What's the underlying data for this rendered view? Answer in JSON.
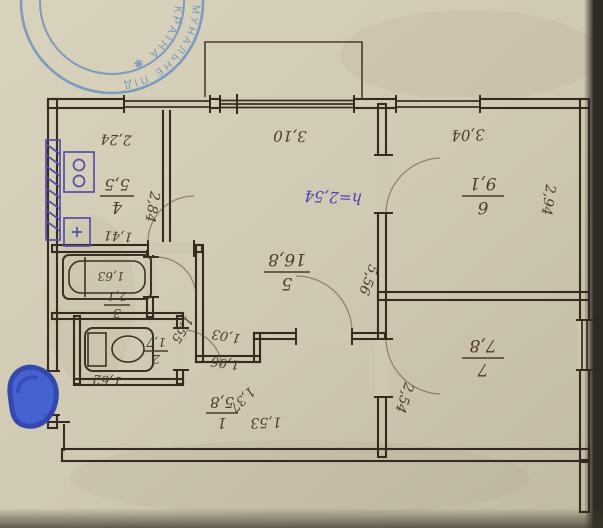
{
  "stamp": {
    "ring_outer": "ЖИТЛОВО КОМУНАЛЬНЕ ПІД",
    "ring_inner": "✱ УКРАЇНА ✱"
  },
  "note": {
    "ceiling_height": "h=2,54"
  },
  "rooms": {
    "kitchen": {
      "number": "4",
      "area": "5,5"
    },
    "living": {
      "number": "5",
      "area": "16,8"
    },
    "bedroom6": {
      "number": "6",
      "area": "9,1"
    },
    "bedroom7": {
      "number": "7",
      "area": "7,8"
    },
    "hall": {
      "number": "1",
      "area": "5,8"
    },
    "bathroom": {
      "number": "3",
      "area": "2,1"
    },
    "wc": {
      "number": "2",
      "area": "1,7"
    }
  },
  "dims": {
    "kitchen_top": "2,24",
    "kitchen_side": "2,84",
    "kitchen_bottom": "1,41",
    "living_top": "3,10",
    "living_side": "5,56",
    "bedroom6_top": "3,04",
    "bedroom6_side": "2,94",
    "bedroom7_side": "2,54",
    "corridor_diag": "1,55",
    "notch_top": "1,03",
    "notch_bottom": "1,06",
    "hall_diag": "1,37",
    "hall_bottom": "1,53",
    "hall_left": "1,62",
    "bathtub_length": "1,63"
  },
  "colors": {
    "paper": "#cfc8b2",
    "ink": "#362b1e",
    "pen_blue": "#4545af",
    "fixture_purple": "#584ea8",
    "stamp_blue": "#6d92bf",
    "blob_blue": "#3f5ed2"
  }
}
